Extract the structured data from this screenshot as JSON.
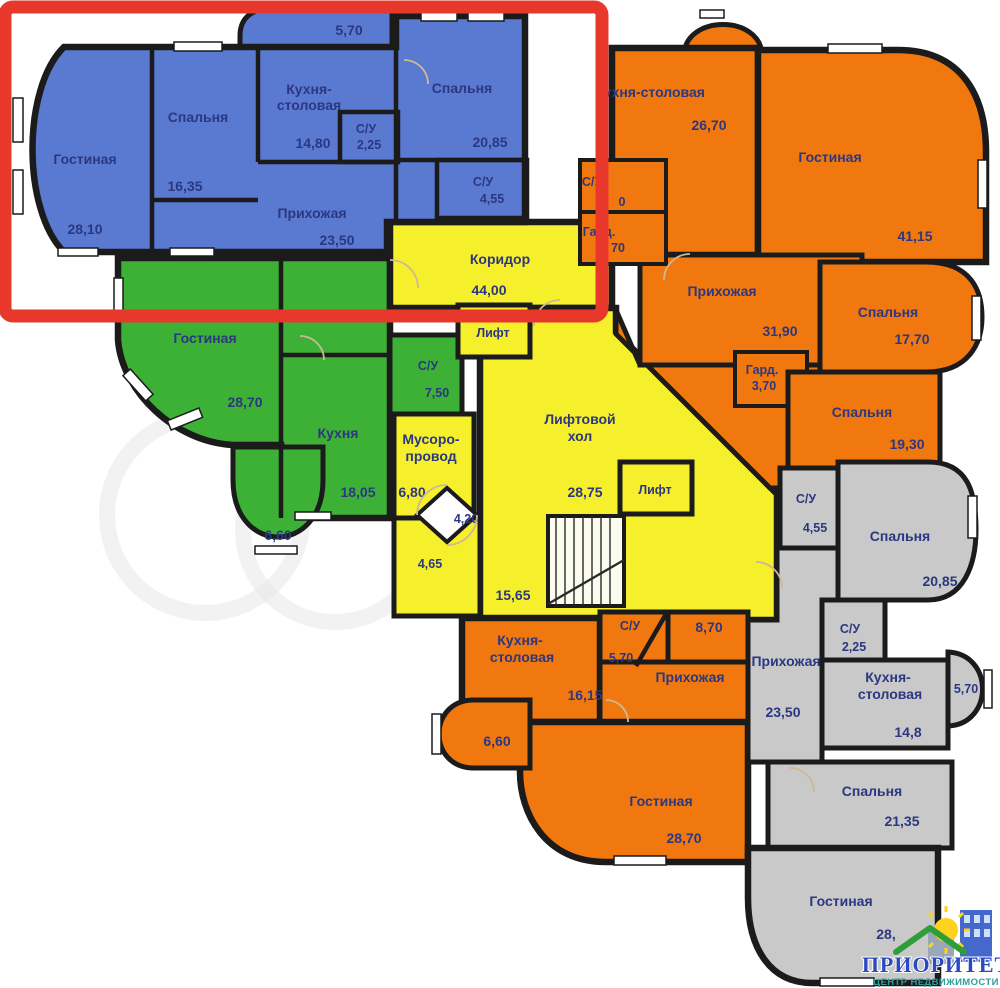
{
  "annotation": {
    "color": "#e8382c"
  },
  "logo": {
    "title": "ПРИОРИТЕТ",
    "subtitle": "ЦЕНТР НЕДВИЖИМОСТИ",
    "title_color": "#2b49c0",
    "subtitle_color": "#2f9e9b",
    "sun_color": "#ffd21e",
    "house_color": "#2e9e3a",
    "building_color": "#4468cc"
  },
  "colors": {
    "walls": "#1b1b1b"
  },
  "apartments": [
    {
      "id": "apartment-highlighted-blue",
      "color": "#5a7ad1",
      "rooms": [
        {
          "name": "Гостиная",
          "area": "28,10"
        },
        {
          "name": "Спальня",
          "area": "16,35"
        },
        {
          "name": "Кухня-",
          "name2": "столовая",
          "area": "14,80"
        },
        {
          "name": "С/У",
          "area": "2,25"
        },
        {
          "name": "Спальня",
          "area": "20,85"
        },
        {
          "name": "С/У",
          "area": "4,55"
        },
        {
          "name": "Прихожая",
          "area": "23,50"
        },
        {
          "area": "5,70"
        }
      ]
    },
    {
      "id": "apartment-green",
      "color": "#3db135",
      "rooms": [
        {
          "name": "Гостиная",
          "area": "28,70"
        },
        {
          "name": "С/У",
          "area": "7,50"
        },
        {
          "name": "Кухня",
          "area": "18,05"
        },
        {
          "area": "6,60"
        }
      ]
    },
    {
      "id": "common-area-yellow",
      "color": "#f6f02c",
      "rooms": [
        {
          "name": "Коридор",
          "area": "44,00"
        },
        {
          "name": "Лифт"
        },
        {
          "name": "Лифтовой",
          "name2": "хол",
          "area": "28,75"
        },
        {
          "name": "Лифт"
        },
        {
          "name": "Мусоро-",
          "name2": "провод",
          "area": "6,80"
        },
        {
          "area": "4,20"
        },
        {
          "area": "4,65"
        },
        {
          "area": "15,65"
        }
      ]
    },
    {
      "id": "apartment-orange-right",
      "color": "#f1780e",
      "rooms": [
        {
          "name": "Кухня-столовая",
          "area": "26,70"
        },
        {
          "name": "Гостиная",
          "area": "41,15"
        },
        {
          "name": "С/У",
          "area": "0"
        },
        {
          "name": "Гард.",
          "area": "70"
        },
        {
          "name": "Прихожая",
          "area": "31,90"
        },
        {
          "name": "Гард.",
          "area": "3,70"
        },
        {
          "name": "Спальня",
          "area": "17,70"
        },
        {
          "name": "Спальня",
          "area": "19,30"
        }
      ]
    },
    {
      "id": "apartment-orange-bottom",
      "color": "#f1780e",
      "rooms": [
        {
          "name": "Кухня-",
          "name2": "столовая",
          "area": "16,15"
        },
        {
          "name": "С/У",
          "area": "5,70"
        },
        {
          "area": "8,70"
        },
        {
          "name": "Прихожая"
        },
        {
          "area": "6,60"
        },
        {
          "name": "Гостиная",
          "area": "28,70"
        }
      ]
    },
    {
      "id": "apartment-gray",
      "color": "#c9c9c9",
      "rooms": [
        {
          "name": "С/У",
          "area": "4,55"
        },
        {
          "name": "Спальня",
          "area": "20,85"
        },
        {
          "name": "С/У",
          "area": "2,25"
        },
        {
          "name": "Прихожая",
          "area": "23,50"
        },
        {
          "name": "Кухня-",
          "name2": "столовая",
          "area": "14,8"
        },
        {
          "area": "5,70"
        },
        {
          "name": "Спальня",
          "area": "21,35"
        },
        {
          "name": "Гостиная",
          "area": "28,"
        }
      ]
    }
  ]
}
